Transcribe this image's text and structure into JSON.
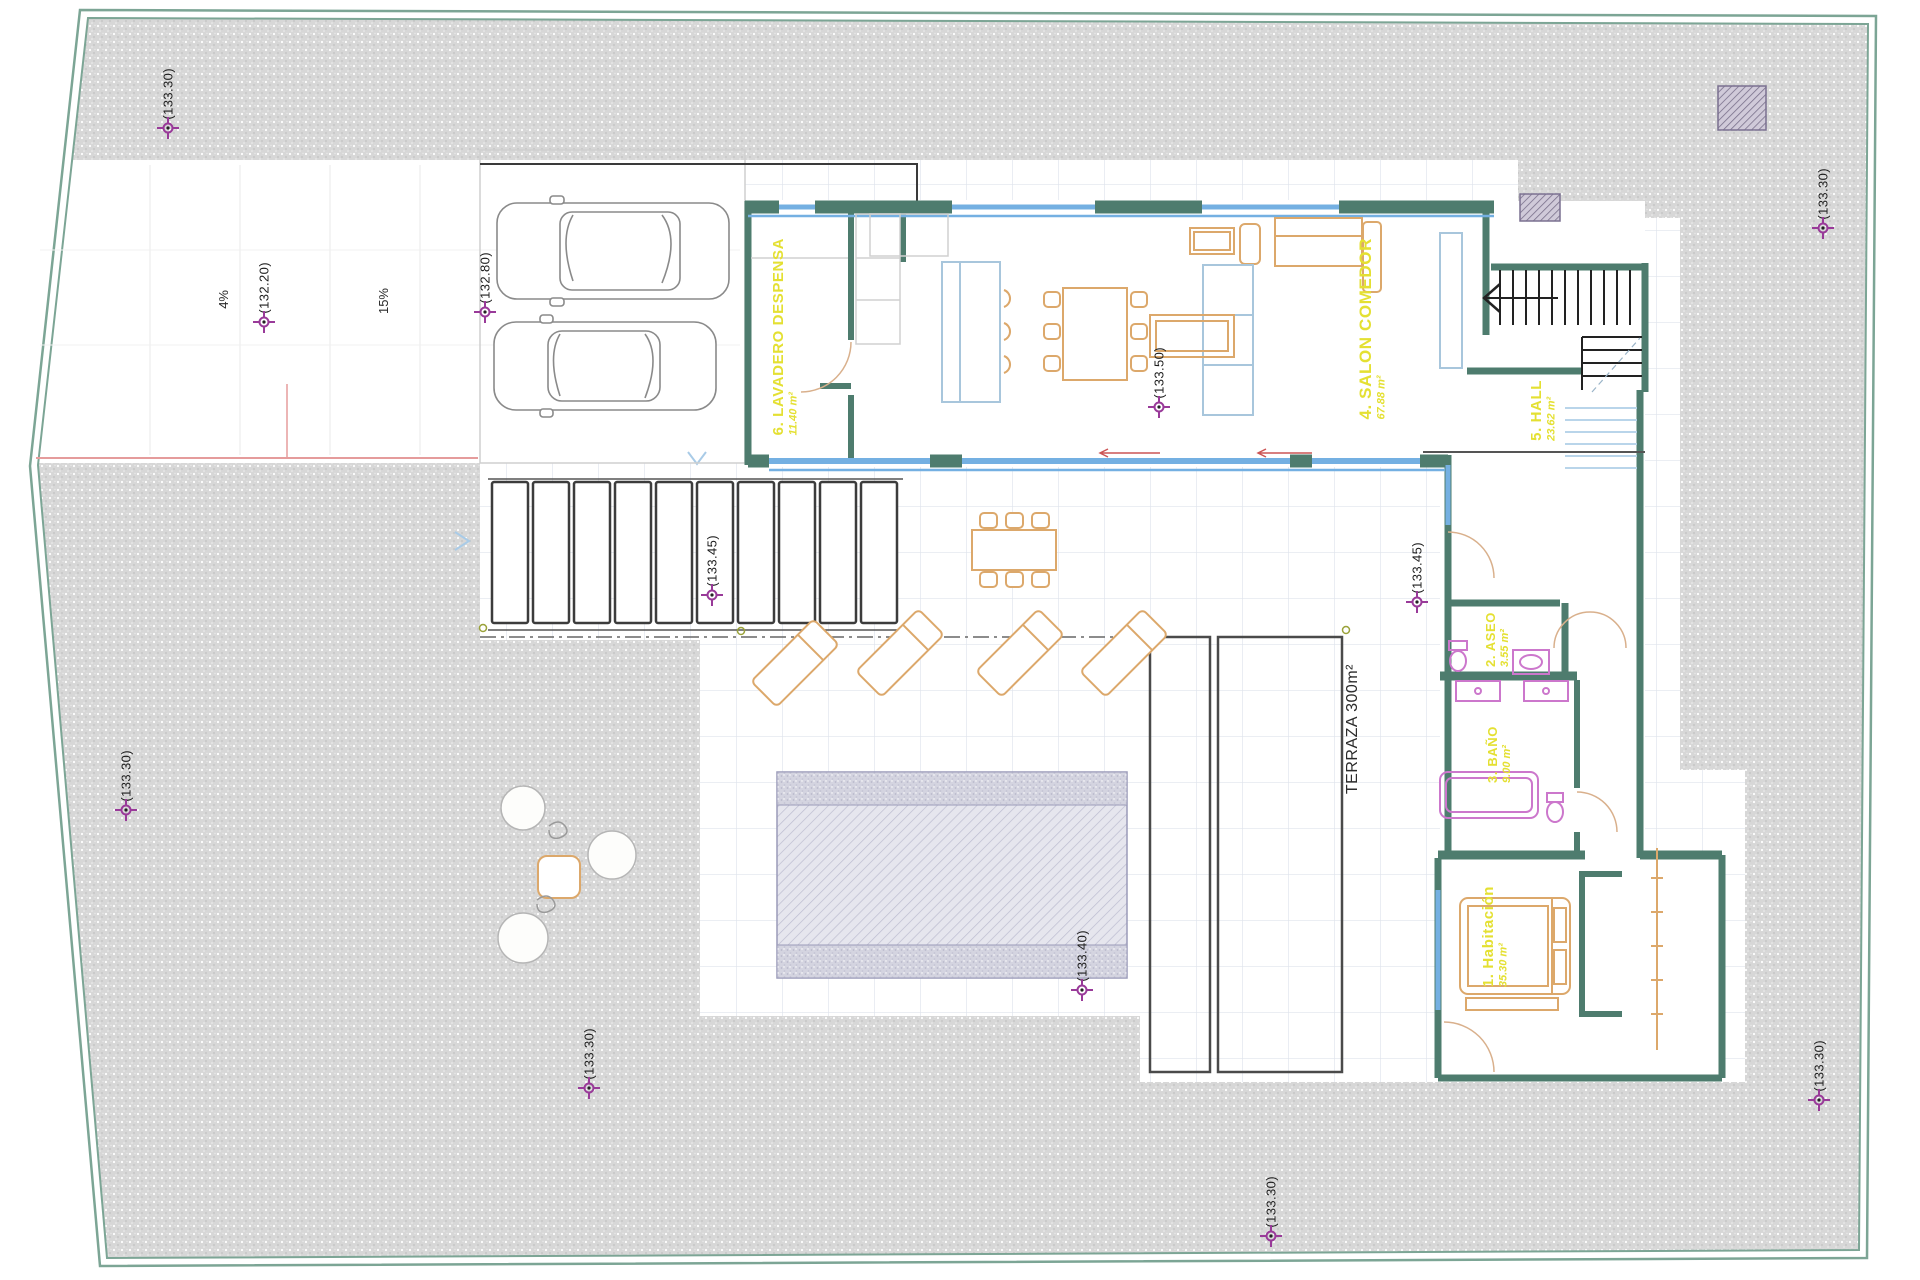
{
  "plan": {
    "markers": [
      {
        "label": "(133.30)"
      },
      {
        "label": "(132.20)"
      },
      {
        "label": "(132.80)"
      },
      {
        "label": "(133.50)"
      },
      {
        "label": "(133.45)"
      },
      {
        "label": "(133.45)"
      },
      {
        "label": "(133.40)"
      },
      {
        "label": "(133.30)"
      },
      {
        "label": "(133.30)"
      },
      {
        "label": "(133.30)"
      },
      {
        "label": "(133.30)"
      },
      {
        "label": "(133.30)"
      }
    ],
    "slope_labels": {
      "left": "4%",
      "right": "15%"
    },
    "rooms": {
      "lavadero": {
        "name": "6. LAVADERO DESPENSA",
        "area": "11.40 m²"
      },
      "salon": {
        "name": "4. SALON COMEDOR",
        "area": "67.88 m²"
      },
      "hall": {
        "name": "5. HALL",
        "area": "23.62 m²"
      },
      "aseo": {
        "name": "2. ASEO",
        "area": "3.55 m²"
      },
      "bano": {
        "name": "3. BAÑO",
        "area": "9.00 m²"
      },
      "habitacion": {
        "name": "1. Habitación",
        "area": "35.30 m²"
      }
    },
    "annotations": {
      "terraza": "TERRAZA 300m²"
    },
    "colors": {
      "boundary": "#7ca595",
      "wall": "#4e7c6e",
      "window": "#74b0e2",
      "furniture": "#dca86b",
      "fixture": "#cc77cc",
      "room_label": "#e4e032",
      "marker": "#993a99",
      "terrain": "#d7d7d7"
    }
  }
}
